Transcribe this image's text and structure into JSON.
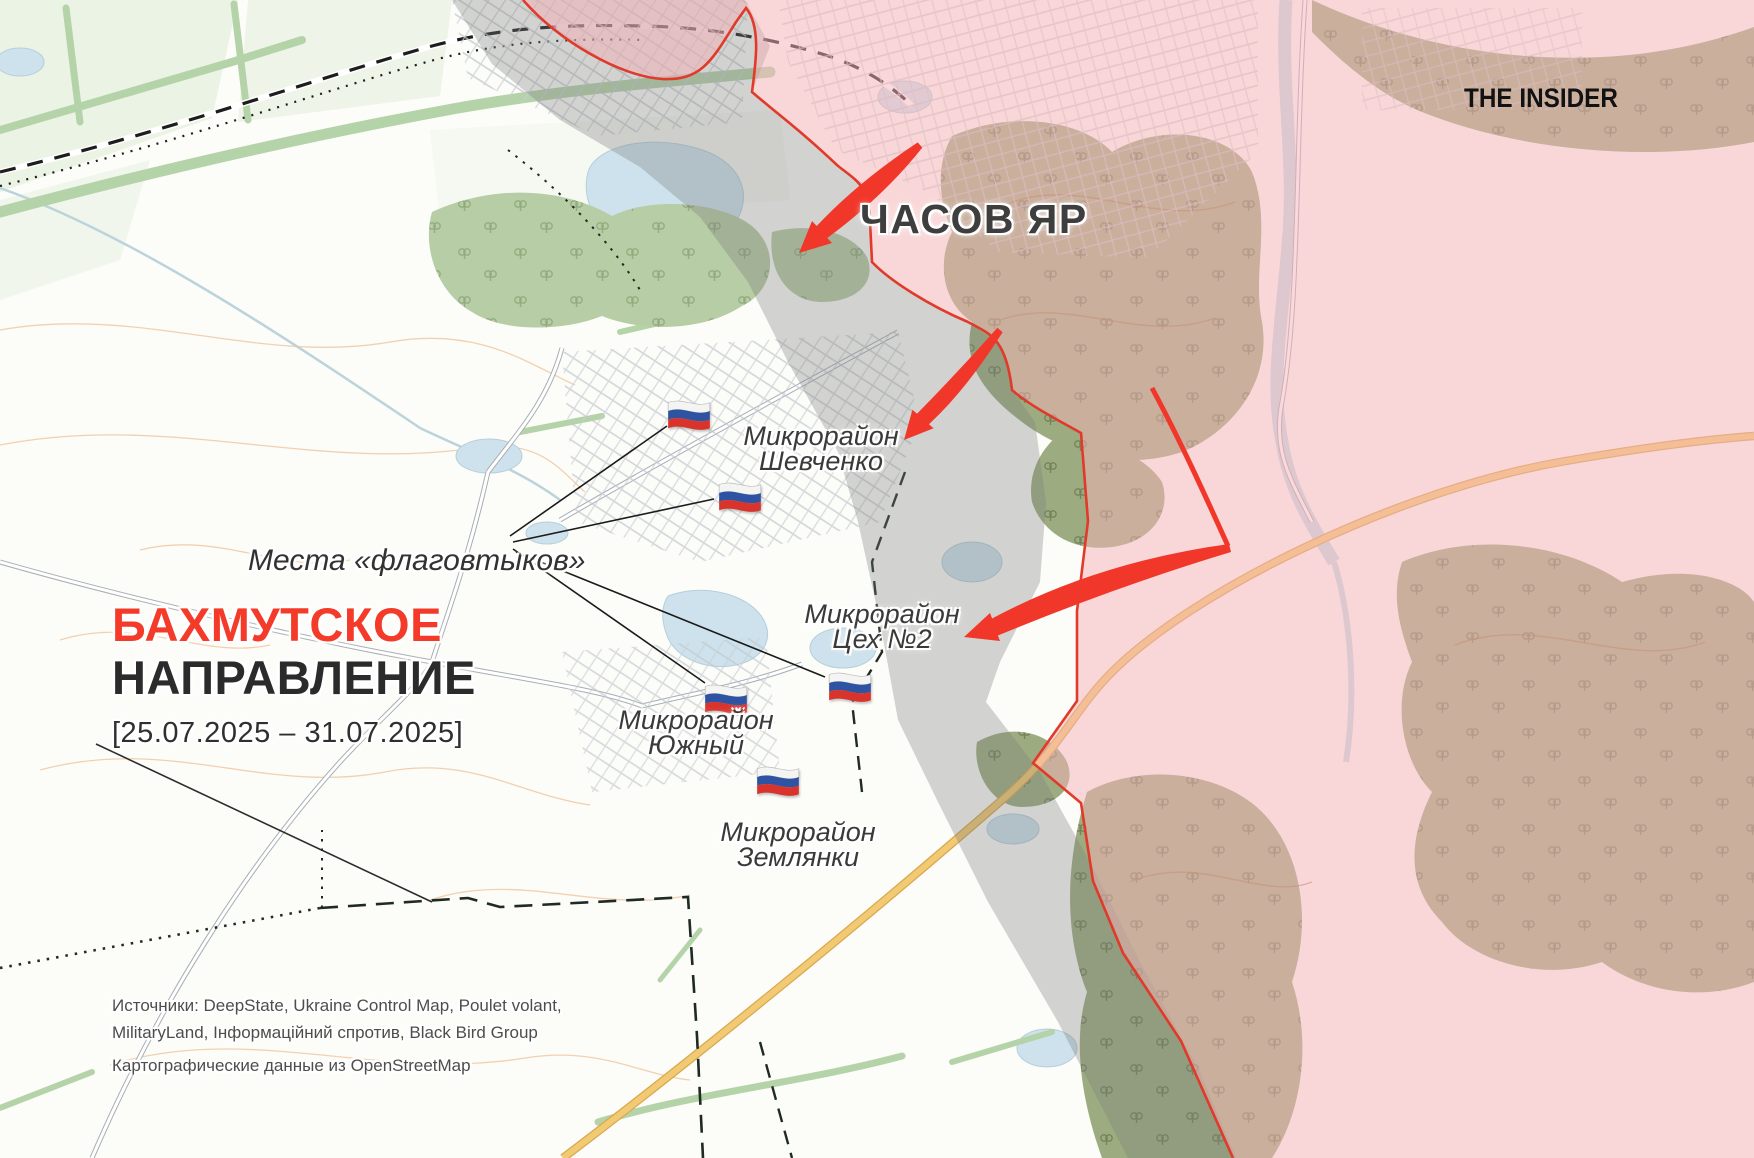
{
  "map_title": {
    "heading_red": "БАХМУТСКОЕ",
    "heading_black": "НАПРАВЛЕНИЕ",
    "date_range": "[25.07.2025 – 31.07.2025]"
  },
  "branding": {
    "logo_text": "THE INSIDER"
  },
  "labels": {
    "city": "ЧАСОВ ЯР",
    "flag_note": "Места «флаговтыков»",
    "districts": [
      {
        "line1": "Микрорайон",
        "line2": "Шевченко"
      },
      {
        "line1": "Микрорайон",
        "line2": "Цех №2"
      },
      {
        "line1": "Микрорайон",
        "line2": "Южный"
      },
      {
        "line1": "Микрорайон",
        "line2": "Землянки"
      }
    ]
  },
  "sources": {
    "line1": "Источники: DeepState, Ukraine Control Map, Poulet volant,",
    "line2": "MilitaryLand, Інформаційний спротив, Black Bird Group",
    "line3": "Картографические данные из OpenStreetMap"
  },
  "legend": {
    "occupied_fill": "#f3b6ba",
    "frontline_color": "#e03a2b",
    "contested_fill": "#8f8f8f",
    "attack_arrow_color": "#f0372a",
    "title_red": "#f43b29",
    "flag_icon": "russian-flag-icon",
    "flag_count": 5
  }
}
